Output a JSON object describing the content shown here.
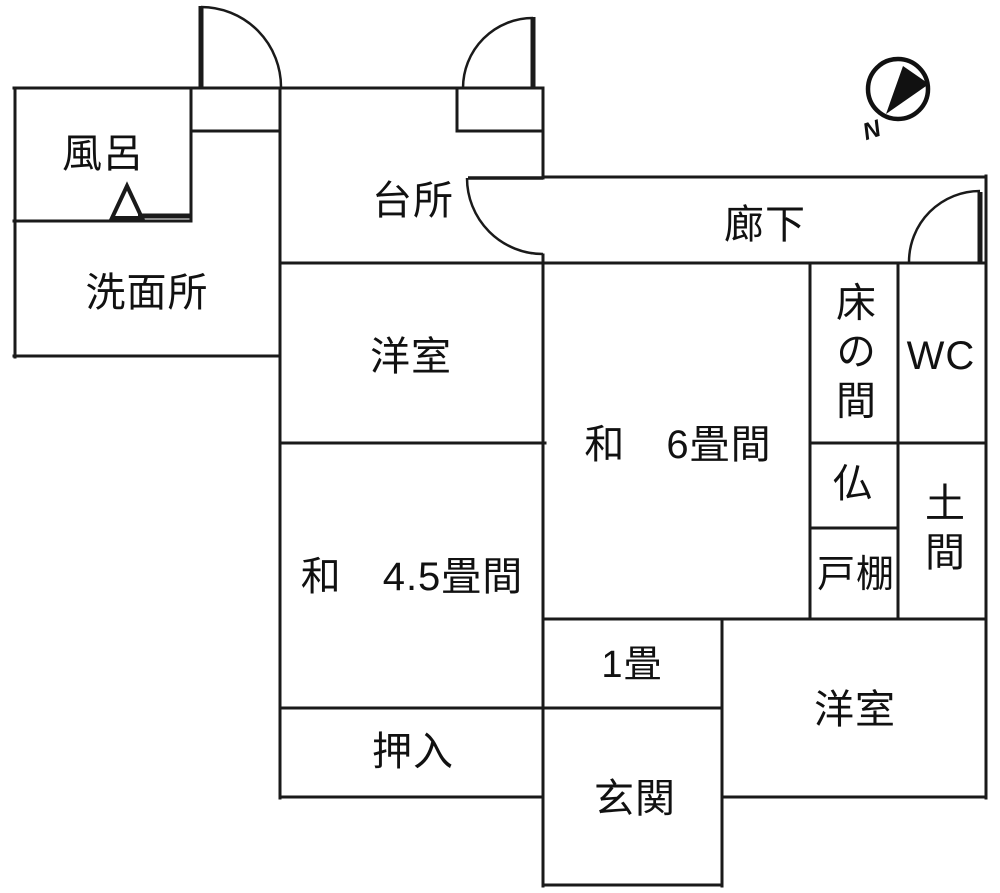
{
  "compass": {
    "label": "N"
  },
  "rooms": [
    {
      "id": "bath",
      "label": "風呂"
    },
    {
      "id": "washroom",
      "label": "洗面所"
    },
    {
      "id": "kitchen",
      "label": "台所"
    },
    {
      "id": "corridor",
      "label": "廊下"
    },
    {
      "id": "western-room-upper",
      "label": "洋室"
    },
    {
      "id": "japanese-6-tatami",
      "label": "和　6畳間"
    },
    {
      "id": "tokonoma",
      "label": "床の間"
    },
    {
      "id": "wc",
      "label": "WC"
    },
    {
      "id": "butsudan",
      "label": "仏"
    },
    {
      "id": "doma",
      "label": "土間"
    },
    {
      "id": "cupboard",
      "label": "戸棚"
    },
    {
      "id": "japanese-4-5-tatami",
      "label": "和　4.5畳間"
    },
    {
      "id": "one-tatami",
      "label": "1畳"
    },
    {
      "id": "closet",
      "label": "押入"
    },
    {
      "id": "entrance",
      "label": "玄関"
    },
    {
      "id": "western-room-lower",
      "label": "洋室"
    }
  ],
  "colors": {
    "line": "#1a1a1a",
    "background": "#ffffff"
  }
}
